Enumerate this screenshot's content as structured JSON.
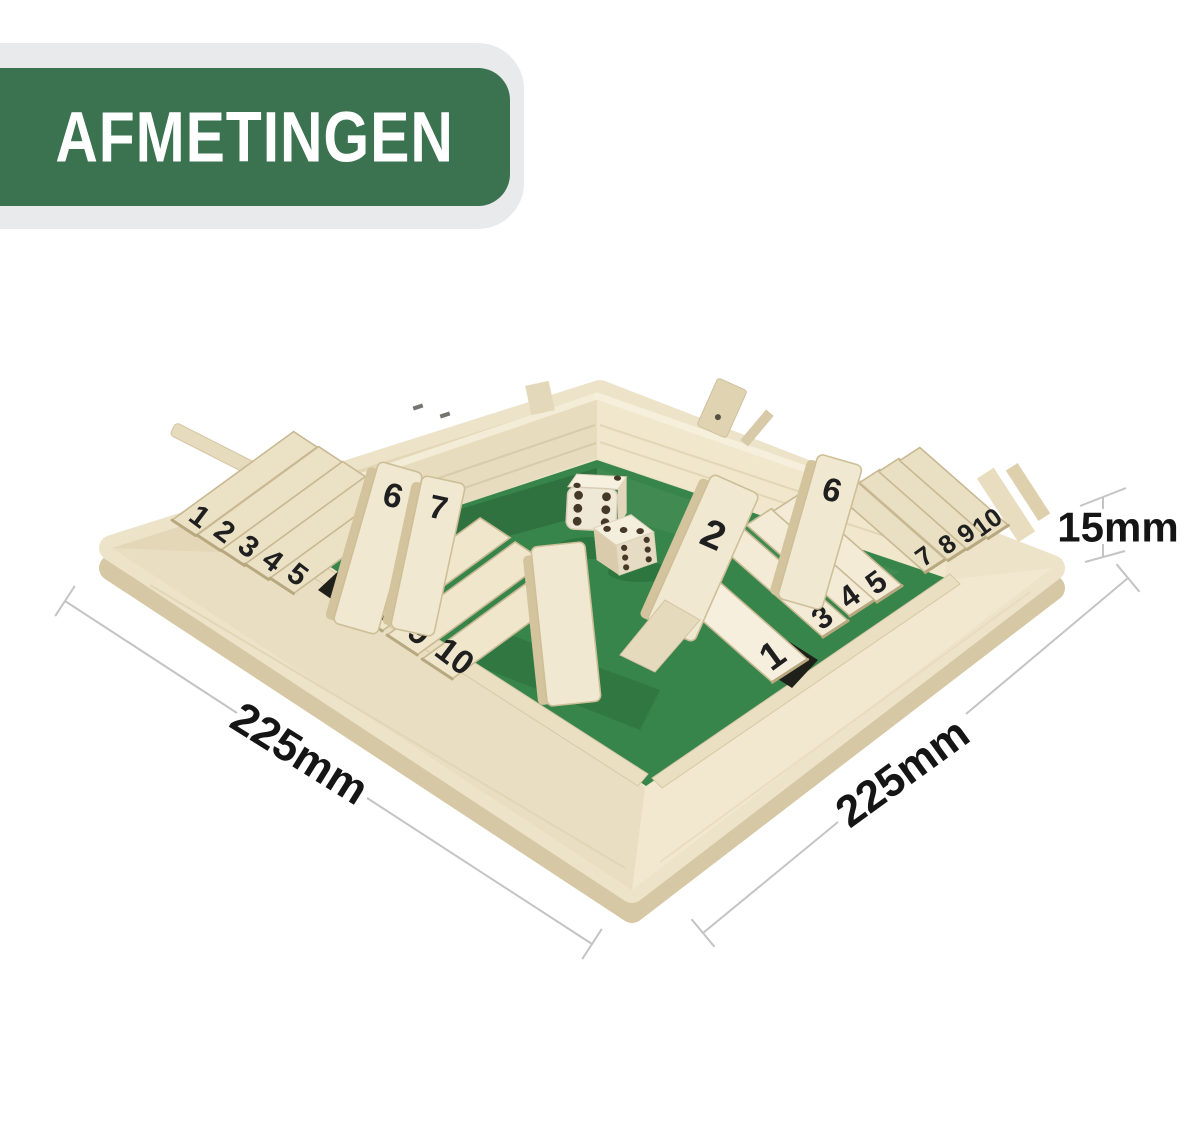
{
  "banner": {
    "label": "AFMETINGEN",
    "background_color": "#3b7350",
    "panel_color": "#e8eaec",
    "text_color": "#ffffff"
  },
  "measurements": {
    "left_width": "225mm",
    "right_depth": "225mm",
    "height": "15mm",
    "line_color": "#c4c4c4",
    "label_color": "#151515"
  },
  "board": {
    "felt_color": "#37854a",
    "slot_color": "#20201a",
    "wood_light": "#ece3c9",
    "wood_dark": "#d6c8a4",
    "tile_rows": {
      "left_flat_a": [
        "1",
        "2",
        "3",
        "4",
        "5"
      ],
      "left_standing": [
        "6",
        "7"
      ],
      "left_flat_b": [
        "8",
        "9",
        "10"
      ],
      "right_flat_a": [
        "1",
        "3",
        "4",
        "5"
      ],
      "right_standing": [
        "2",
        "6"
      ],
      "right_flat_b": [
        "7",
        "8",
        "9",
        "10"
      ]
    },
    "dice": [
      {
        "top": 2,
        "front": 6
      },
      {
        "top": 3,
        "front": 6
      }
    ]
  }
}
